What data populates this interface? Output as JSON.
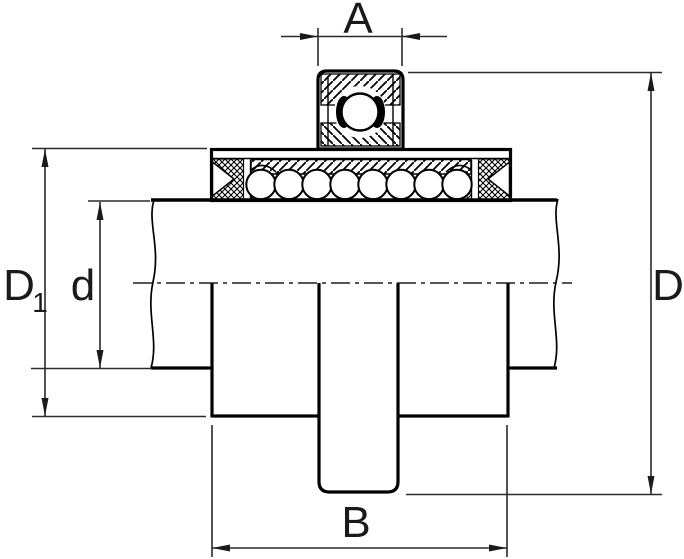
{
  "drawing": {
    "labels": {
      "a": "A",
      "b": "B",
      "d_outer": "D",
      "d1_main": "D",
      "d1_sub": "1",
      "d_shaft": "d"
    },
    "colors": {
      "line": "#000000",
      "dimension": "#2a2a2a",
      "background": "#ffffff"
    }
  }
}
